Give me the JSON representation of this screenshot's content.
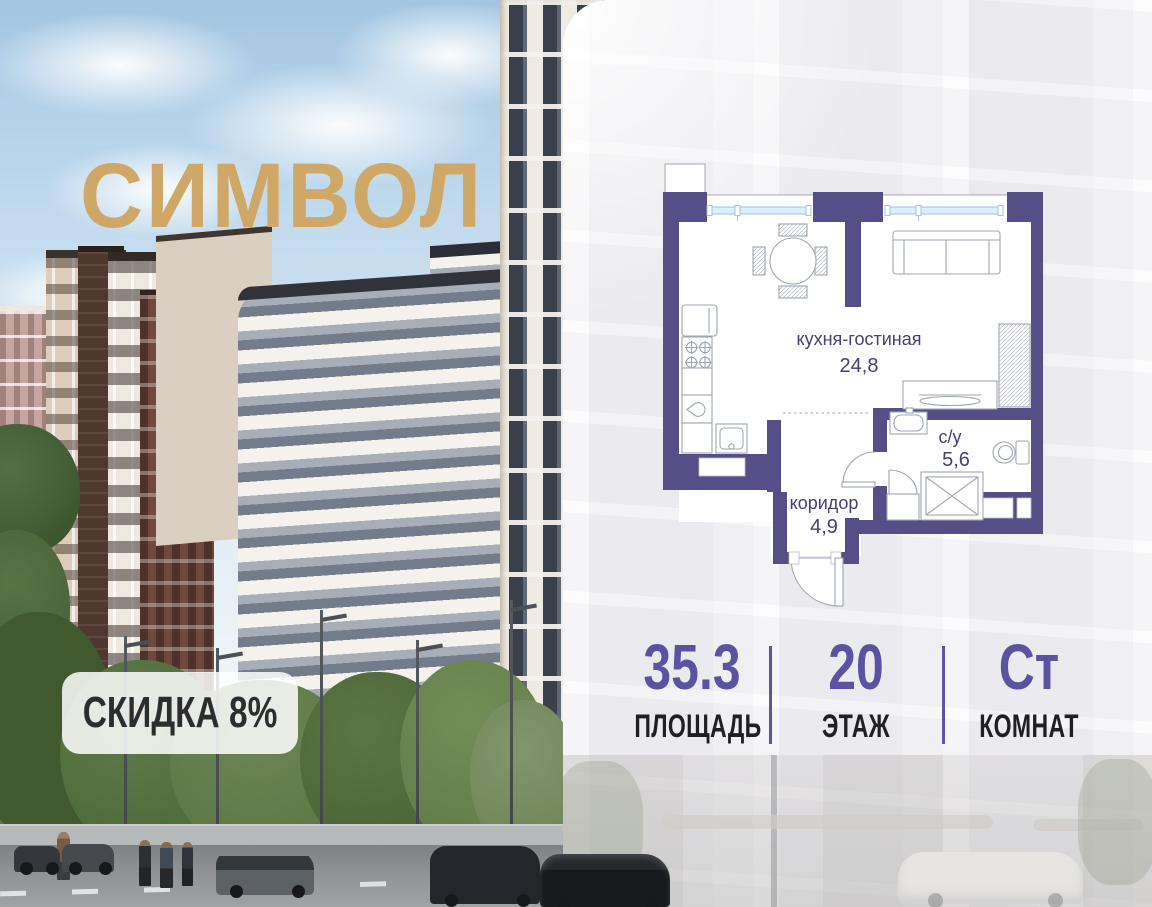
{
  "branding": {
    "project_name": "СИМВОЛ",
    "logo_color": "#CFA767",
    "discount_badge": "СКИДКА 8%"
  },
  "floor_plan": {
    "wall_color": "#564E86",
    "label_color": "#454072",
    "window_color": "#8FC2E2",
    "rooms": [
      {
        "name": "кухня-гостиная",
        "area": "24,8"
      },
      {
        "name": "с/у",
        "area": "5,6"
      },
      {
        "name": "коридор",
        "area": "4,9"
      }
    ]
  },
  "stats": {
    "accent_color": "#5B53A1",
    "items": [
      {
        "value": "35.3",
        "label": "ПЛОЩАДЬ"
      },
      {
        "value": "20",
        "label": "ЭТАЖ"
      },
      {
        "value": "Ст",
        "label": "КОМНАТ"
      }
    ]
  }
}
